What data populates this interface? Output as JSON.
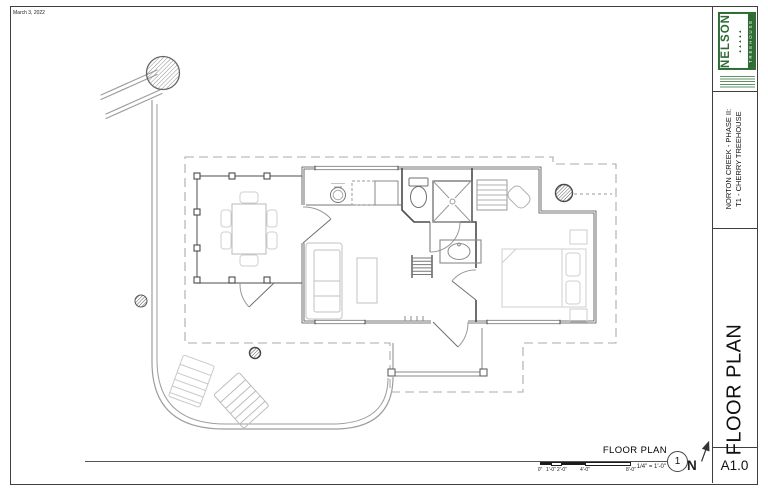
{
  "sheet": {
    "date": "March 3, 2022"
  },
  "title_block": {
    "project_line1": "NORTON CREEK - PHASE II:",
    "project_line2": "T1 - CHERRY TREEHOUSE",
    "sheet_title": "FLOOR PLAN",
    "sheet_number": "A1.0"
  },
  "logo": {
    "name_primary": "NELSON",
    "name_secondary": "TREEHOUSE",
    "trees_glyph": "▲▲▲▲▲",
    "green": "#2e6b33"
  },
  "drawing_title": {
    "label": "FLOOR PLAN",
    "scale": "1/4\" = 1'-0\"",
    "detail_number": "1",
    "north_label": "N"
  },
  "scale_bar": {
    "labels": [
      "0\"",
      "1'-0\"",
      "2'-0\"",
      "4'-0\"",
      "8'-0\""
    ]
  },
  "colors": {
    "wall": "#4b4b4b",
    "site_line": "#9e9e9e",
    "roof_dash": "#ababab",
    "furniture": "#c4c4c4"
  }
}
